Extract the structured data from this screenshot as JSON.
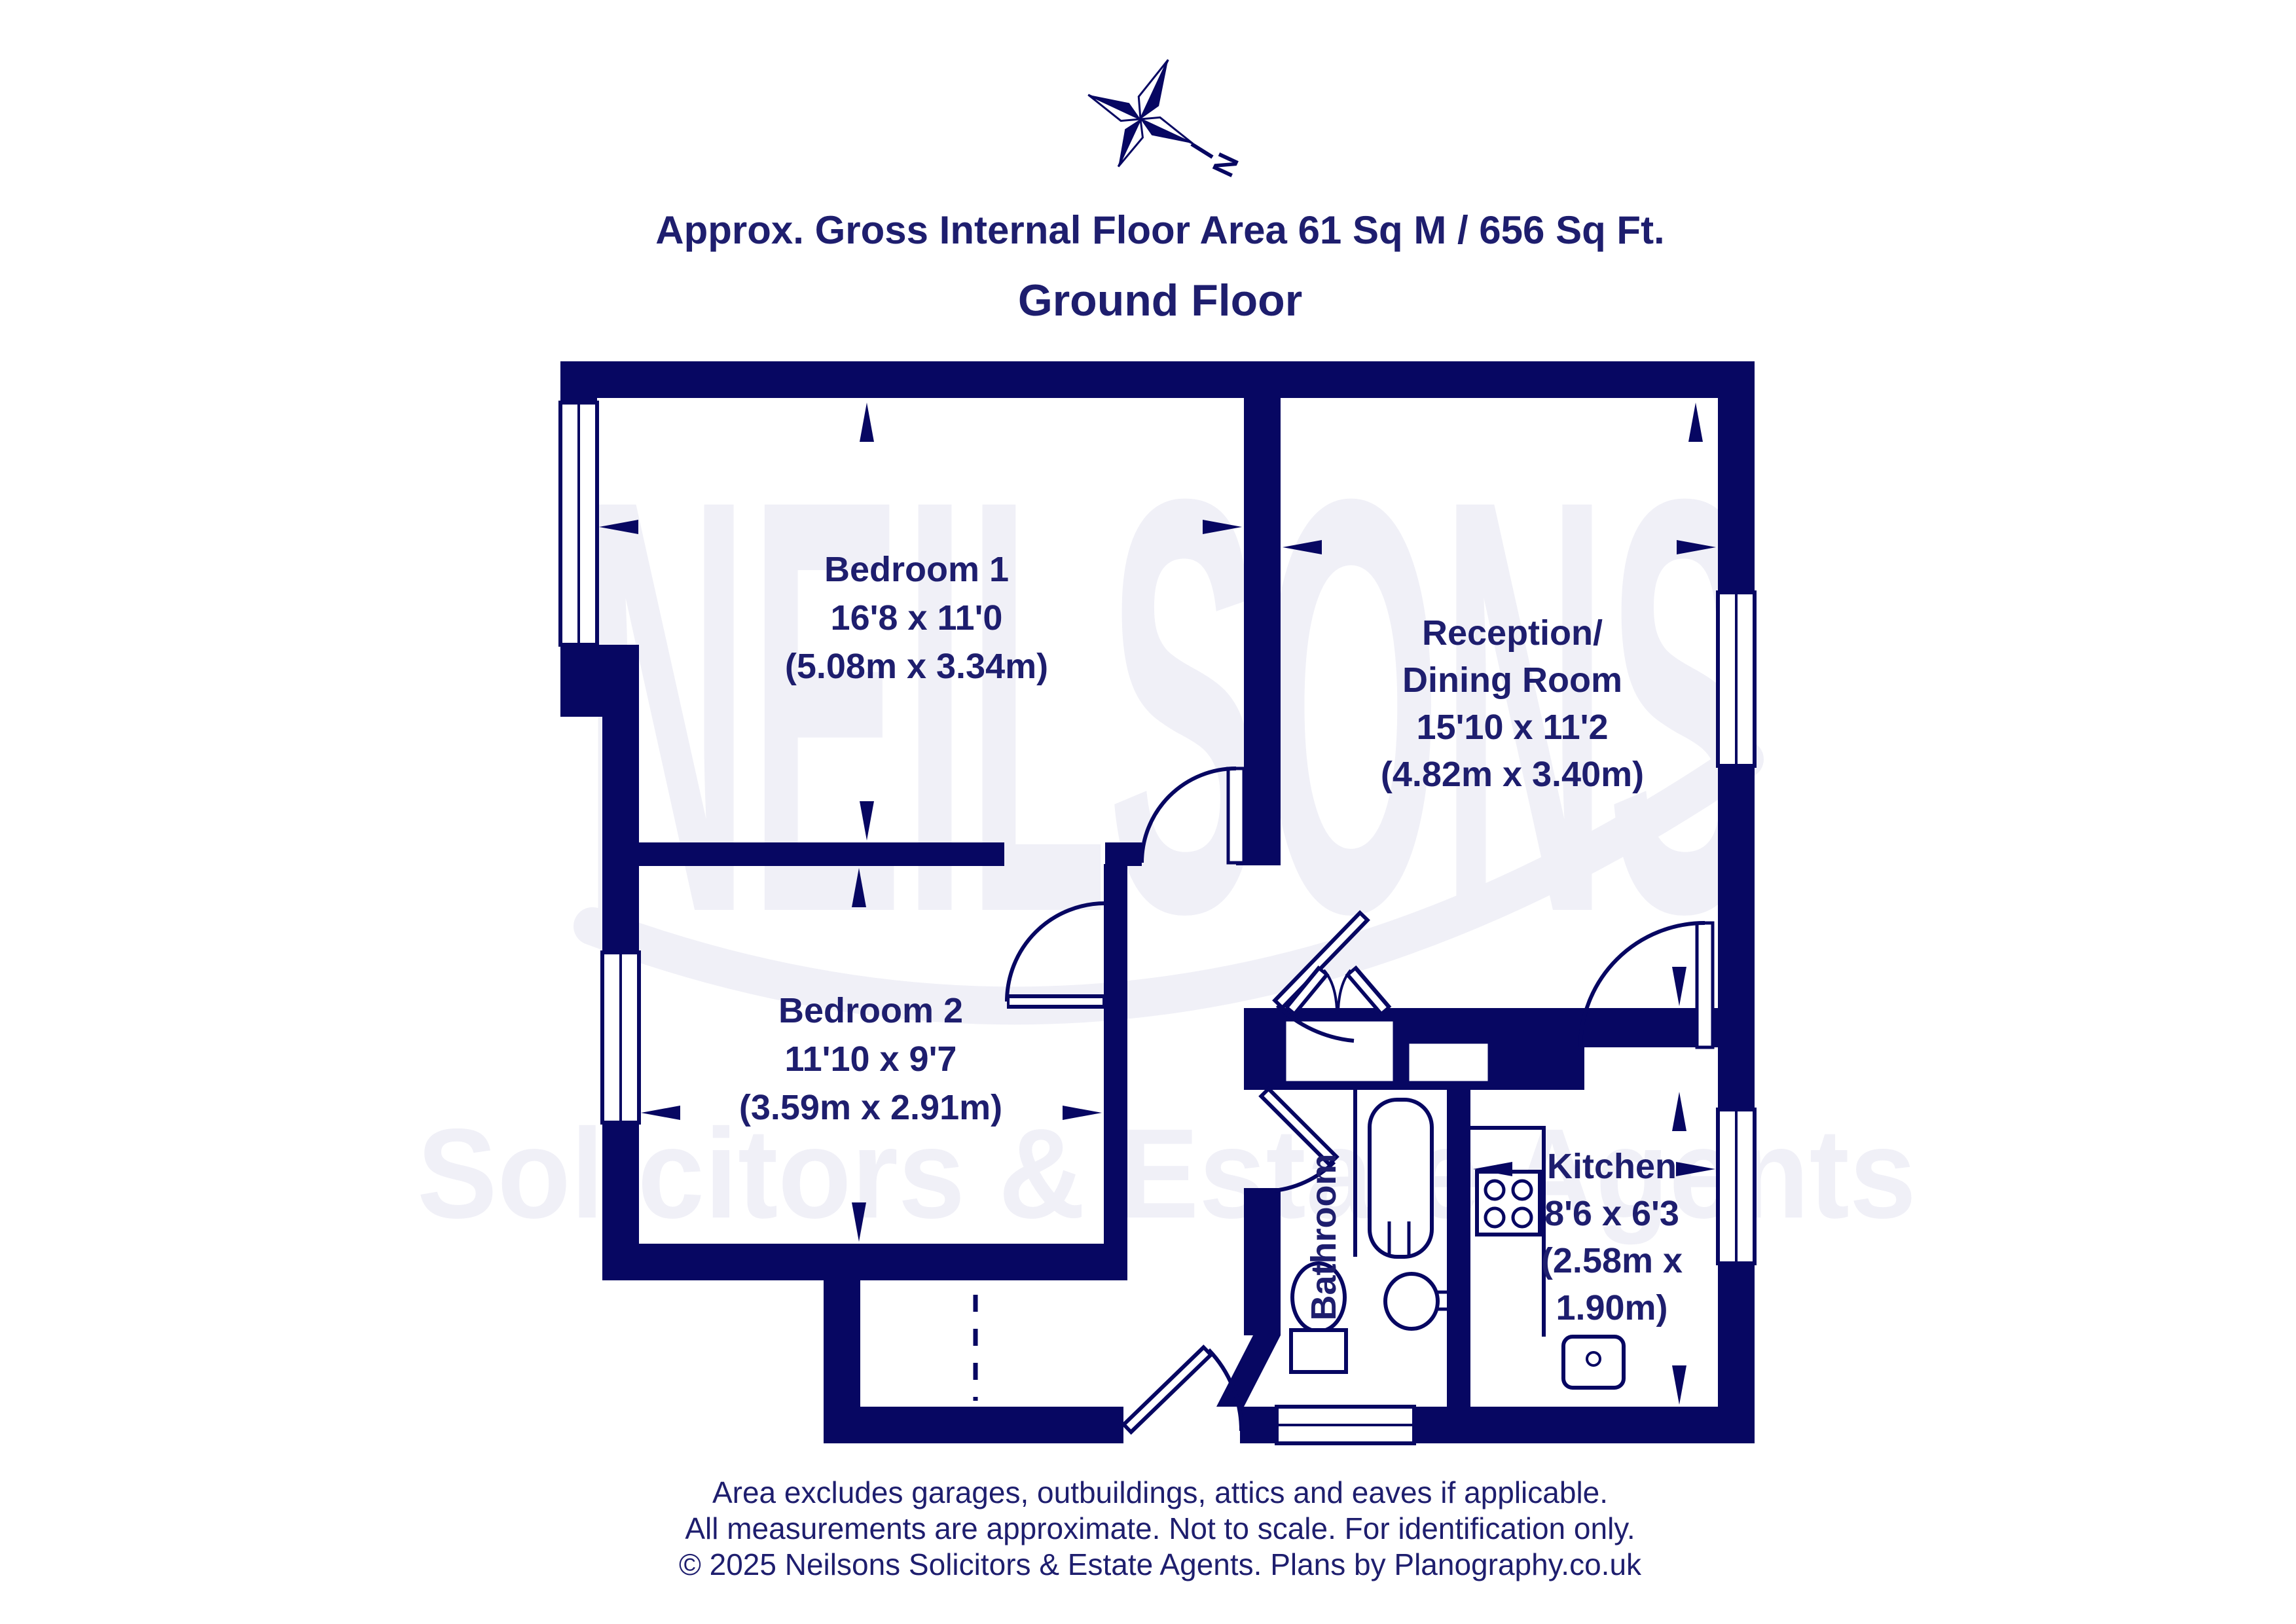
{
  "header": {
    "area_line": "Approx. Gross Internal Floor Area 61 Sq M / 656 Sq Ft.",
    "floor_label": "Ground Floor"
  },
  "compass": {
    "north_label": "N"
  },
  "rooms": {
    "bedroom1": {
      "name": "Bedroom 1",
      "imperial": "16'8 x 11'0",
      "metric": "(5.08m x 3.34m)"
    },
    "reception": {
      "name_line1": "Reception/",
      "name_line2": "Dining Room",
      "imperial": "15'10 x 11'2",
      "metric": "(4.82m x 3.40m)"
    },
    "bedroom2": {
      "name": "Bedroom 2",
      "imperial": "11'10 x 9'7",
      "metric": "(3.59m x 2.91m)"
    },
    "kitchen": {
      "name": "Kitchen",
      "imperial": "8'6 x 6'3",
      "metric_line1": "(2.58m x",
      "metric_line2": "1.90m)"
    },
    "bathroom": {
      "name": "Bathroom"
    }
  },
  "watermark": {
    "brand": "NEILSONS",
    "tagline": "Solicitors & Estate Agents"
  },
  "footer": {
    "line1": "Area excludes garages, outbuildings, attics and eaves if applicable.",
    "line2": "All measurements are approximate. Not to scale. For identification only.",
    "line3": "© 2025 Neilsons Solicitors & Estate Agents. Plans by Planography.co.uk"
  },
  "colors": {
    "wall": "#070762",
    "text": "#1e1e6e",
    "watermark": "#f0f0f7",
    "paper": "#ffffff"
  }
}
